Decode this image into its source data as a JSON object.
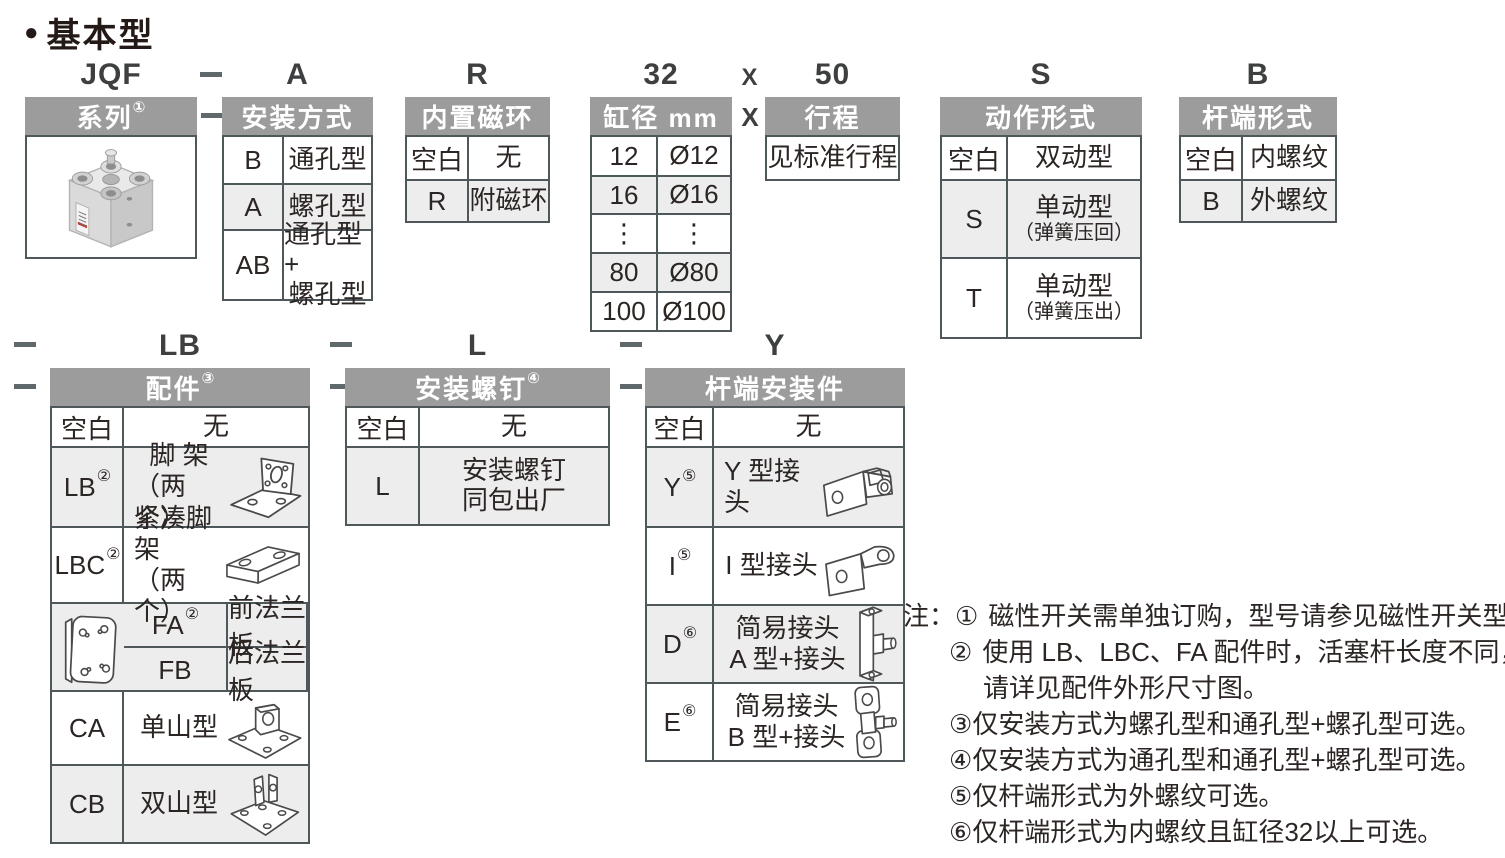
{
  "colors": {
    "header-bg": "#9c9c9c",
    "row-alt": "#ededee",
    "border": "#4e585b",
    "text": "#2b2523",
    "code": "#3d3f40",
    "dash": "#5f696c"
  },
  "title": {
    "bullet": "●",
    "text": "基本型"
  },
  "codes": {
    "series": "JQF",
    "mounting": "A",
    "magnet": "R",
    "bore": "32",
    "times": "X",
    "stroke": "50",
    "action": "S",
    "rod_end": "B",
    "accessory": "LB",
    "screws": "L",
    "rod_mount": "Y"
  },
  "series": {
    "header": "系列",
    "sup": "①",
    "image": "compact-cylinder-photo"
  },
  "mounting": {
    "header": "安装方式",
    "rows": [
      {
        "code": "B",
        "lines": [
          "通孔型"
        ]
      },
      {
        "code": "A",
        "lines": [
          "螺孔型"
        ]
      },
      {
        "code": "AB",
        "lines": [
          "通孔型+",
          "螺孔型"
        ]
      }
    ]
  },
  "magnet": {
    "header": "内置磁环",
    "rows": [
      {
        "code": "空白",
        "lines": [
          "无"
        ]
      },
      {
        "code": "R",
        "lines": [
          "附磁环"
        ]
      }
    ]
  },
  "bore": {
    "header": "缸径 mm",
    "rows": [
      {
        "code": "12",
        "lines": [
          "Ø12"
        ]
      },
      {
        "code": "16",
        "lines": [
          "Ø16"
        ]
      },
      {
        "code": "⋮",
        "lines": [
          "⋮"
        ]
      },
      {
        "code": "80",
        "lines": [
          "Ø80"
        ]
      },
      {
        "code": "100",
        "lines": [
          "Ø100"
        ]
      }
    ]
  },
  "stroke": {
    "header": "行程",
    "times": "X",
    "value": "见标准行程"
  },
  "action": {
    "header": "动作形式",
    "rows": [
      {
        "code": "空白",
        "lines": [
          "双动型"
        ],
        "sub": ""
      },
      {
        "code": "S",
        "lines": [
          "单动型"
        ],
        "sub": "（弹簧压回）"
      },
      {
        "code": "T",
        "lines": [
          "单动型"
        ],
        "sub": "（弹簧压出）"
      }
    ]
  },
  "rod_end": {
    "header": "杆端形式",
    "rows": [
      {
        "code": "空白",
        "lines": [
          "内螺纹"
        ]
      },
      {
        "code": "B",
        "lines": [
          "外螺纹"
        ]
      }
    ]
  },
  "accessory": {
    "header": "配件",
    "sup": "③",
    "rows": [
      {
        "code": "空白",
        "sup": "",
        "line1": "无",
        "line2": "",
        "icon": ""
      },
      {
        "code": "LB",
        "sup": "②",
        "line1": "脚 架",
        "line2": "（两 个）",
        "icon": "foot-bracket-icon"
      },
      {
        "code": "LBC",
        "sup": "②",
        "line1": "紧凑脚架",
        "line2": "（两 个）",
        "icon": "compact-foot-bracket-icon"
      },
      {
        "code": "FA",
        "sup": "②",
        "line1": "前法兰板",
        "line2": "",
        "icon": "flange-plate-icon"
      },
      {
        "code": "FB",
        "sup": "",
        "line1": "后法兰板",
        "line2": "",
        "icon": "flange-plate-icon"
      },
      {
        "code": "CA",
        "sup": "",
        "line1": "单山型",
        "line2": "",
        "icon": "single-clevis-icon"
      },
      {
        "code": "CB",
        "sup": "",
        "line1": "双山型",
        "line2": "",
        "icon": "double-clevis-icon"
      }
    ]
  },
  "screws": {
    "header": "安装螺钉",
    "sup": "④",
    "rows": [
      {
        "code": "空白",
        "line1": "无",
        "line2": ""
      },
      {
        "code": "L",
        "line1": "安装螺钉",
        "line2": "同包出厂"
      }
    ]
  },
  "rod_mount": {
    "header": "杆端安装件",
    "rows": [
      {
        "code": "空白",
        "sup": "",
        "line1": "无",
        "line2": "",
        "icon": ""
      },
      {
        "code": "Y",
        "sup": "⑤",
        "line1": "Y 型接头",
        "line2": "",
        "icon": "y-knuckle-icon"
      },
      {
        "code": "I",
        "sup": "⑤",
        "line1": "I 型接头",
        "line2": "",
        "icon": "i-knuckle-icon"
      },
      {
        "code": "D",
        "sup": "⑥",
        "line1": "简易接头",
        "line2": "A 型+接头",
        "icon": "floating-joint-a-icon"
      },
      {
        "code": "E",
        "sup": "⑥",
        "line1": "简易接头",
        "line2": "B 型+接头",
        "icon": "floating-joint-b-icon"
      }
    ]
  },
  "notes": {
    "label": "注：",
    "items": [
      {
        "num": "①",
        "text": "磁性开关需单独订购，型号请参见磁性开关型号表。"
      },
      {
        "num": "②",
        "text": "使用 LB、LBC、FA 配件时，活塞杆长度不同，"
      },
      {
        "num": "",
        "text": "请详见配件外形尺寸图。"
      },
      {
        "num": "③",
        "text": "仅安装方式为螺孔型和通孔型+螺孔型可选。"
      },
      {
        "num": "④",
        "text": "仅安装方式为通孔型和通孔型+螺孔型可选。"
      },
      {
        "num": "⑤",
        "text": "仅杆端形式为外螺纹可选。"
      },
      {
        "num": "⑥",
        "text": "仅杆端形式为内螺纹且缸径32以上可选。"
      }
    ]
  }
}
